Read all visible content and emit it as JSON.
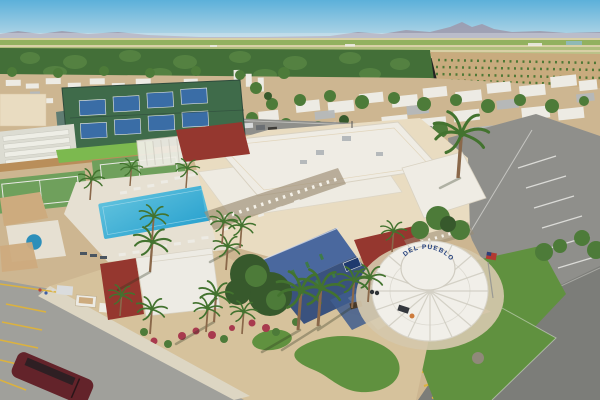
{
  "scene": {
    "description": "Aerial drone view of an RV resort: Del Pueblo clubhouse with a round white spoke canopy and US flag, large blue swimming pool with spa and loungers, fenced blue pickleball courts, green tennis courts, shuffleboard lanes, lawn bowling green, blue two-story building with green shutters, palm trees, rows of RVs and mobile homes, desert gravel landscaping with putting greens, parking lots with a dark red SUV and golf carts, farm fields, orchards and desert mountains on the horizon.",
    "signage": {
      "canopy_text": "DEL PUEBLO"
    }
  },
  "palette": {
    "sky_top": "#5cb0da",
    "sky_horizon": "#c6dfe9",
    "mountain": "#9e92a4",
    "haze": "#e8eef0",
    "field_green": "#86ab52",
    "field_tan": "#d8d0a6",
    "pond": "#8fbccb",
    "orchard": "#436f38",
    "orchard_light": "#62914a",
    "soil": "#c8ab7e",
    "ground_tan": "#cdb691",
    "gravel": "#d6c29c",
    "sidewalk": "#ddd6c3",
    "apron": "#d5c8ab",
    "rv_white": "#edebe4",
    "roof_gray": "#b5b9bb",
    "tree": "#4d7b39",
    "tree_dark": "#37592c",
    "court_fence_green": "#3f6b4a",
    "court_blue": "#3a6da6",
    "fence_dark": "#2e4a3c",
    "tennis_green": "#6fa05c",
    "lawn_bright": "#7cb94f",
    "shuffle": "#dcdcd2",
    "lane": "#eeeee6",
    "fence_wood": "#b98e5a",
    "teal_wall": "#5a7a72",
    "cream": "#e9dcc1",
    "roof_white": "#efece4",
    "maroon": "#95372f",
    "shadow_band": "#9b8c72",
    "column_white": "#f4f1e8",
    "pool": "#2aa2cf",
    "pool_light": "#5fc1dd",
    "spa_blue": "#2d8fba",
    "deck": "#e6e0d2",
    "shade_tan": "#cdab7e",
    "blue_building": "#4a689e",
    "blue_dark": "#3a527e",
    "shutter_green": "#3e7a49",
    "canopy_white": "#f1efe9",
    "spoke": "#cfccc1",
    "sign_blue": "#23407e",
    "street": "#8f8f8b",
    "asphalt": "#7c7d79",
    "parking": "#a0a09b",
    "line_yellow": "#dcb23e",
    "line_white": "#e9e9e5",
    "lawn": "#60913f",
    "suv_red": "#63232a",
    "rock": "#90897a",
    "flower": "#a83a4e",
    "trunk": "#8a684a",
    "palm_green": "#43732f",
    "flag_red": "#b23a31",
    "flag_blue": "#2c3f79",
    "shadow": "rgba(45,52,32,0.32)"
  }
}
